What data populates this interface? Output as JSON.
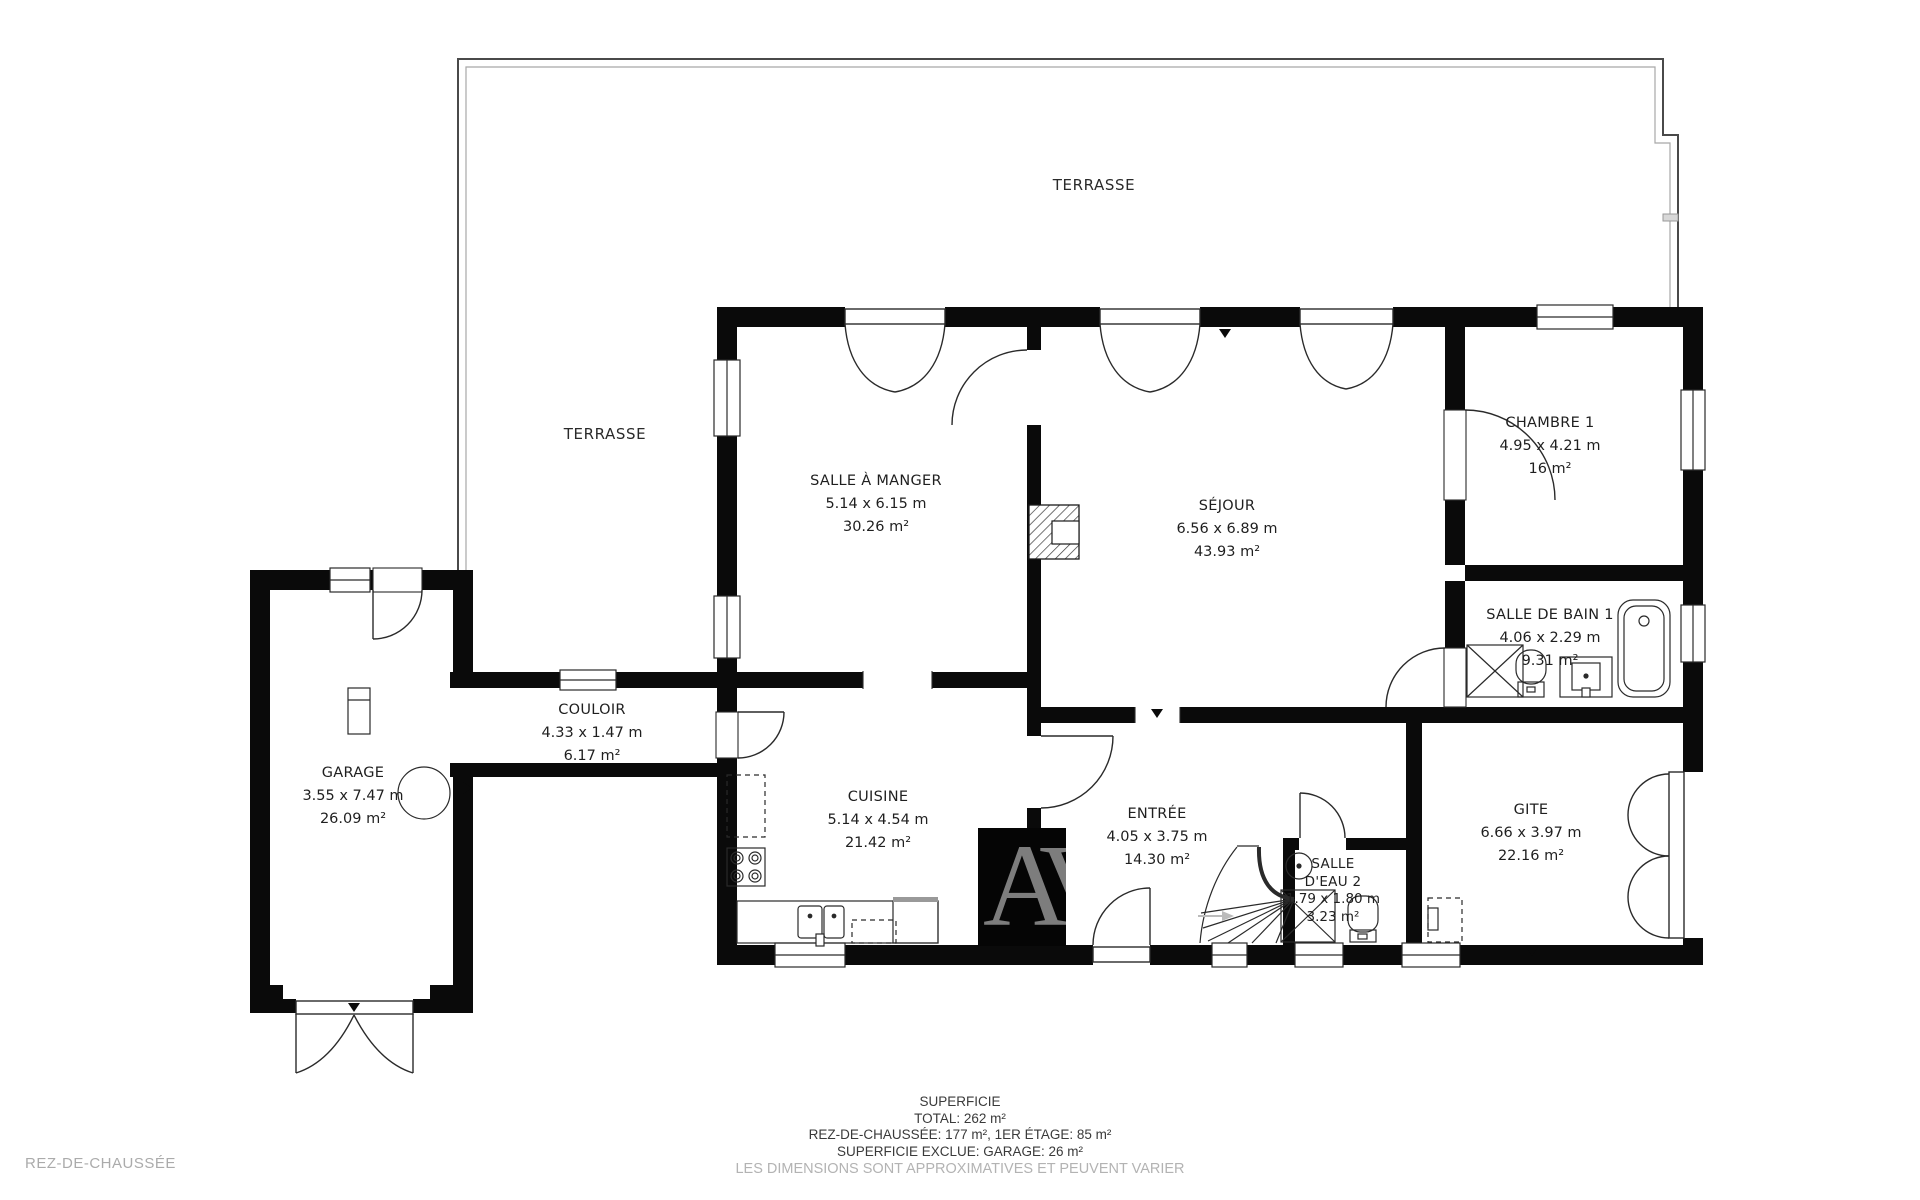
{
  "floor_label": "REZ-DE-CHAUSSÉE",
  "watermark": "AV",
  "terraces": [
    {
      "label": "TERRASSE"
    },
    {
      "label": "TERRASSE"
    }
  ],
  "rooms": [
    {
      "name": "SALLE À MANGER",
      "dims": "5.14 x 6.15 m",
      "area": "30.26 m²"
    },
    {
      "name": "SÉJOUR",
      "dims": "6.56 x 6.89 m",
      "area": "43.93 m²"
    },
    {
      "name": "CHAMBRE 1",
      "dims": "4.95 x 4.21 m",
      "area": "16 m²"
    },
    {
      "name": "SALLE DE BAIN 1",
      "dims": "4.06 x 2.29 m",
      "area": "9.31 m²"
    },
    {
      "name": "COULOIR",
      "dims": "4.33 x 1.47 m",
      "area": "6.17 m²"
    },
    {
      "name": "GARAGE",
      "dims": "3.55 x 7.47 m",
      "area": "26.09 m²"
    },
    {
      "name": "CUISINE",
      "dims": "5.14 x 4.54 m",
      "area": "21.42 m²"
    },
    {
      "name": "ENTRÉE",
      "dims": "4.05 x 3.75 m",
      "area": "14.30 m²"
    },
    {
      "name_line1": "SALLE",
      "name_line2": "D'EAU 2",
      "dims": "1.79 x 1.80 m",
      "area": "3.23 m²"
    },
    {
      "name": "GITE",
      "dims": "6.66 x 3.97 m",
      "area": "22.16 m²"
    }
  ],
  "footer": {
    "title": "SUPERFICIE",
    "total": "TOTAL: 262 m²",
    "floors": "REZ-DE-CHAUSSÉE: 177 m², 1ER ÉTAGE: 85 m²",
    "excluded": "SUPERFICIE EXCLUE: GARAGE: 26 m²",
    "disclaimer": "LES DIMENSIONS SONT APPROXIMATIVES ET PEUVENT VARIER"
  }
}
